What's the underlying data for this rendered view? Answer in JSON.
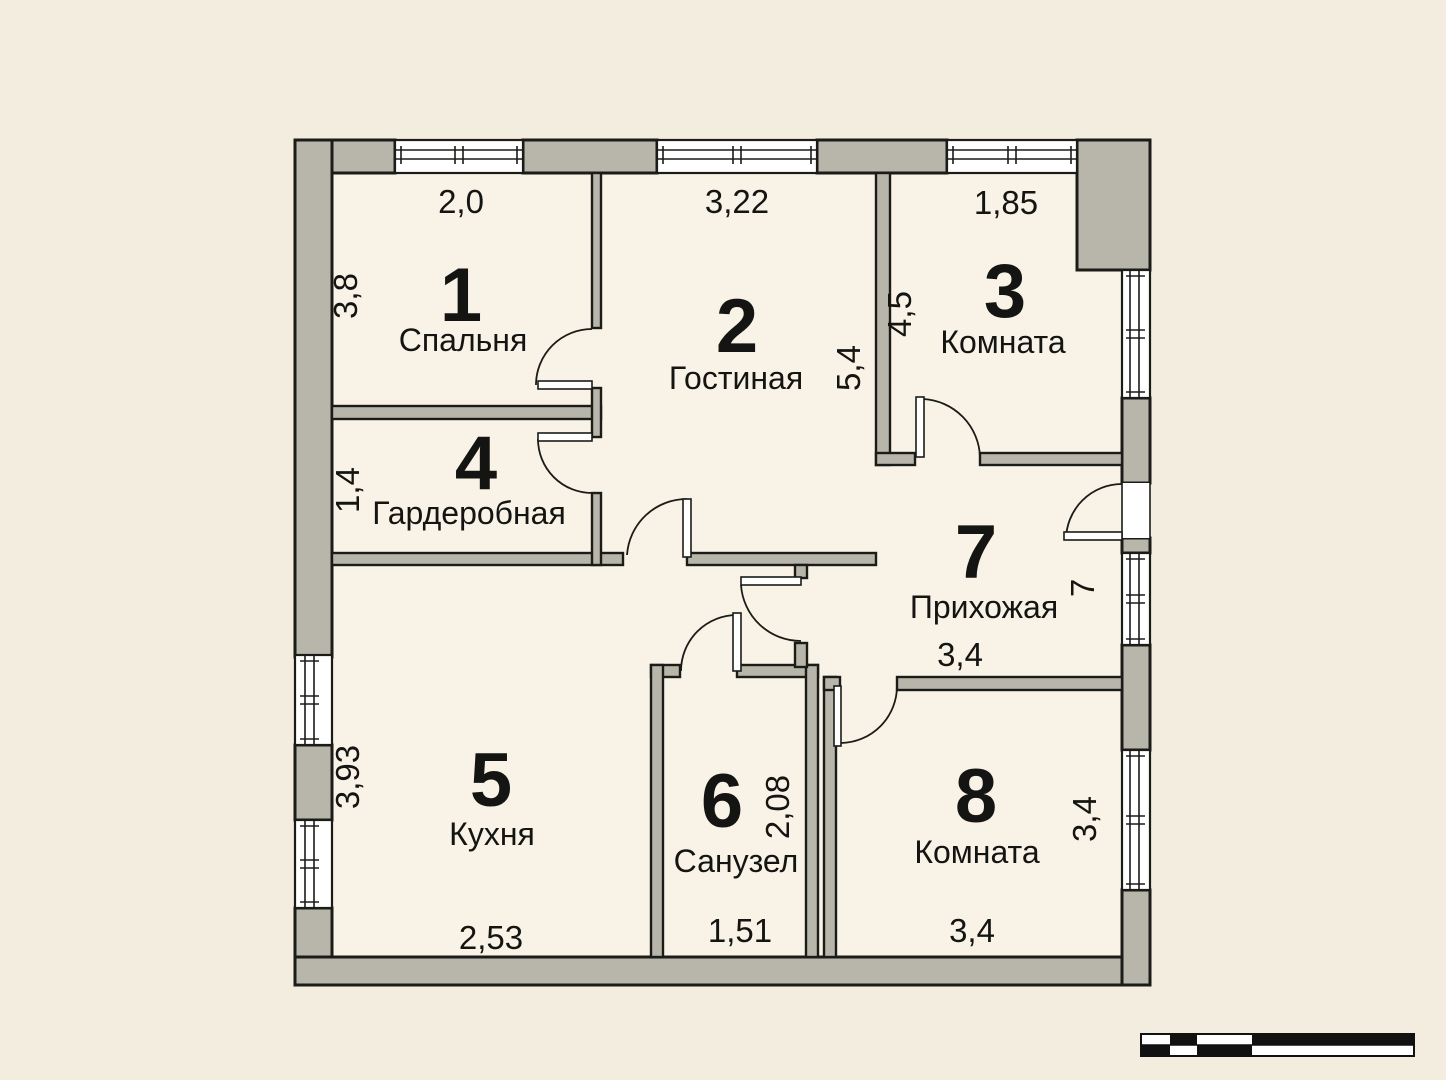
{
  "plan": {
    "type": "apartment-floor-plan",
    "language": "ru"
  },
  "colors": {
    "background": "#f2edde",
    "room_fill": "#f8f3e6",
    "wall_fill": "#b8b5ab",
    "outline": "#1b1b18",
    "label": "#141412",
    "scale_bar": "#111111"
  },
  "rooms": [
    {
      "number": "1",
      "name": "Спальня",
      "dim_top": "2,0",
      "dim_side": "3,8"
    },
    {
      "number": "2",
      "name": "Гостиная",
      "dim_top": "3,22",
      "dim_side": "5,4"
    },
    {
      "number": "3",
      "name": "Комната",
      "dim_top": "1,85",
      "dim_side": "4,5"
    },
    {
      "number": "4",
      "name": "Гардеробная",
      "dim_side": "1,4"
    },
    {
      "number": "5",
      "name": "Кухня",
      "dim_side": "3,93",
      "dim_bottom": "2,53"
    },
    {
      "number": "6",
      "name": "Санузел",
      "dim_side": "2,08",
      "dim_bottom": "1,51"
    },
    {
      "number": "7",
      "name": "Прихожая",
      "dim_side": "7",
      "dim_bottom": "3,4"
    },
    {
      "number": "8",
      "name": "Комната",
      "dim_side": "3,4",
      "dim_bottom": "3,4"
    }
  ]
}
